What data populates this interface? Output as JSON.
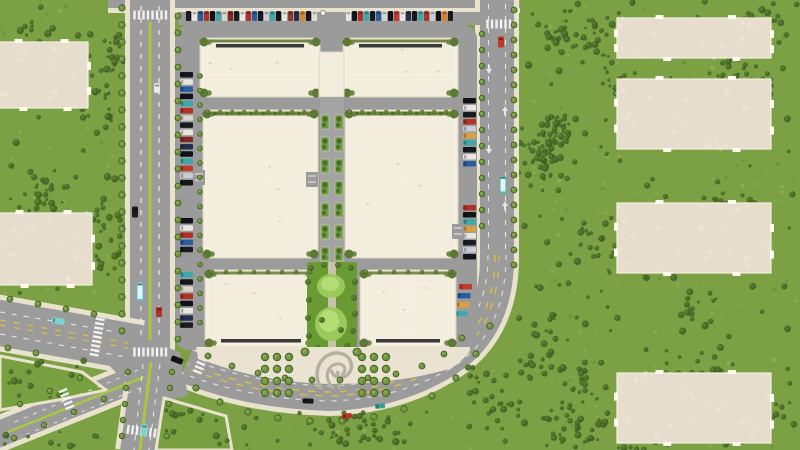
{
  "scene": {
    "width": 800,
    "height": 450,
    "description": "Top-down aerial city-builder view of a shopping mall complex with parking rows, tree-lined avenues, a landscaped plaza with emblem, central pocket park, and sand building pads on surrounding grassland"
  },
  "palette": {
    "grass_base": "#7ca044",
    "grass_light": "#93b455",
    "grass_dark": "#5f7f30",
    "grass_speck": "#a3c162",
    "tree_dark": "#3f6024",
    "tree_mid": "#577f2d",
    "street_tree": "#6e9140",
    "street_tree_rim": "#3f5c20",
    "road_asphalt": "#9b9b9b",
    "sidewalk": "#e9e2cd",
    "building_roof": "#f3eddd",
    "building_edge": "#ddd5c0",
    "roof_seam": "#ffffff",
    "roof_strip": "#3a3a3a",
    "hedge": "#6d813c",
    "hedge_tree": "#4c6d2a",
    "pad_sand": "#e6ddcd",
    "pad_tab": "#fffbee",
    "median_green": "#a7c93f",
    "lane_white": "#f2f2f2",
    "lane_yellow": "#d9c33c",
    "park_green": "#6a9a33",
    "lawn_light": "#9cc95c",
    "lawn_lighter": "#b5dd75",
    "plaza": "#eae3d1",
    "emblem_gray": "#b5afa3",
    "island_grass": "#78a040"
  },
  "mall": {
    "site": {
      "x": 175,
      "y": 25,
      "w": 302,
      "h": 325
    },
    "buildings": [
      {
        "id": "store-north-west",
        "x": 200,
        "y": 38,
        "w": 120,
        "h": 59,
        "style": "north"
      },
      {
        "id": "store-north-east",
        "x": 343,
        "y": 38,
        "w": 115,
        "h": 59,
        "style": "north"
      },
      {
        "id": "store-mid-west",
        "x": 203,
        "y": 110,
        "w": 115,
        "h": 148,
        "style": "mid"
      },
      {
        "id": "store-mid-east",
        "x": 345,
        "y": 110,
        "w": 113,
        "h": 148,
        "style": "mid"
      },
      {
        "id": "store-south-west",
        "x": 205,
        "y": 270,
        "w": 112,
        "h": 77,
        "style": "south"
      },
      {
        "id": "store-south-east",
        "x": 360,
        "y": 270,
        "w": 96,
        "h": 77,
        "style": "south-grid"
      }
    ],
    "connector": {
      "x": 319,
      "y": 52,
      "w": 25,
      "h": 45
    },
    "corridor": {
      "x": 320,
      "y": 97,
      "w": 24,
      "h": 173
    },
    "park": {
      "x": 307,
      "y": 262,
      "w": 50,
      "h": 91
    },
    "plaza": {
      "x": 196,
      "y": 347,
      "w": 274,
      "h": 50
    }
  },
  "pads": [
    {
      "id": "pad-left-1",
      "x": -10,
      "y": 42,
      "w": 98,
      "h": 66
    },
    {
      "id": "pad-left-2",
      "x": -10,
      "y": 213,
      "w": 102,
      "h": 72
    },
    {
      "id": "pad-right-1",
      "x": 617,
      "y": 18,
      "w": 154,
      "h": 40
    },
    {
      "id": "pad-right-2",
      "x": 617,
      "y": 79,
      "w": 154,
      "h": 70
    },
    {
      "id": "pad-right-3",
      "x": 617,
      "y": 203,
      "w": 154,
      "h": 70
    },
    {
      "id": "pad-right-4",
      "x": 617,
      "y": 373,
      "w": 154,
      "h": 70
    }
  ],
  "parking": {
    "top_row_west": [
      "#1a1c22",
      "#e8e6df",
      "#30599c",
      "#b03226",
      "#111318",
      "#3fa8a8",
      "#d8d5cc",
      "#7e2c22",
      "#1a1c22",
      "#e8e6df",
      "#b03226",
      "#2b5d9e",
      "#17191f",
      "#caced4",
      "#3fa8a8",
      "#101218",
      "#e8e6df",
      "#8f3a2c",
      "#23304d",
      "#d8822f",
      "#15171c",
      "#e0ddd4"
    ],
    "top_row_east": [
      "#e8e6df",
      "#15171c",
      "#b03226",
      "#3fa8a8",
      "#1a1c22",
      "#2b5d9e",
      "#d8d5cc",
      "#111318",
      "#c23a2c",
      "#e8e6df",
      "#23304d",
      "#17191f",
      "#3fa8a8",
      "#b03226",
      "#caced4",
      "#101218",
      "#d8822f",
      "#1a1c22"
    ],
    "left_col_a": [
      "#15171c",
      "#e8e6df",
      "#2b5d9e",
      "#111318",
      "#3fa8a8",
      "#b03226",
      "#d8d5cc",
      "#1a1c22",
      "#e8e6df",
      "#7e2c22",
      "#23304d",
      "#101218",
      "#3fa8a8",
      "#c23a2c",
      "#caced4",
      "#15171c"
    ],
    "left_col_b": [
      "#111318",
      "#e8e6df",
      "#b03226",
      "#2b5d9e",
      "#1a1c22"
    ],
    "left_col_c": [
      "#3fa8a8",
      "#15171c",
      "#d8d5cc",
      "#b03226",
      "#111318",
      "#e8e6df",
      "#23304d",
      "#1a1c22"
    ],
    "right_col_a": [
      "#111318",
      "#e8e6df",
      "#1a1c22",
      "#b03226",
      "#caced4",
      "#d8a13d",
      "#3fa8a8",
      "#15171c",
      "#e8e6df",
      "#2b5d9e"
    ],
    "right_col_b": [
      "#b03226",
      "#111318",
      "#3fa8a8",
      "#d8a13d",
      "#e8e6df",
      "#1a1c22",
      "#caced4",
      "#15171c"
    ],
    "right_col_curve": [
      "#c23a2c",
      "#2b5d9e",
      "#d8a13d",
      "#3fa8a8"
    ]
  },
  "vehicles": [
    {
      "name": "car-red-right-avenue",
      "x": 501,
      "y": 42,
      "w": 6,
      "h": 11,
      "angle": 0,
      "color": "#c0392b",
      "kind": "car"
    },
    {
      "name": "bus-teal-right-avenue",
      "x": 503,
      "y": 185,
      "w": 7,
      "h": 17,
      "angle": 0,
      "color": "#4ab5ad",
      "kind": "bus"
    },
    {
      "name": "car-white-west-avenue",
      "x": 157,
      "y": 88,
      "w": 6,
      "h": 10,
      "angle": 0,
      "color": "#e8e8e4",
      "kind": "car"
    },
    {
      "name": "car-black-west-avenue",
      "x": 135,
      "y": 212,
      "w": 6,
      "h": 11,
      "angle": 0,
      "color": "#1c1c1e",
      "kind": "car"
    },
    {
      "name": "bus-cyan-west-avenue",
      "x": 140,
      "y": 292,
      "w": 7,
      "h": 18,
      "angle": 0,
      "color": "#58c2c9",
      "kind": "bus"
    },
    {
      "name": "car-red-west-avenue",
      "x": 159,
      "y": 312,
      "w": 6,
      "h": 10,
      "angle": 0,
      "color": "#b23327",
      "kind": "car"
    },
    {
      "name": "car-cyan-west-road",
      "x": 58,
      "y": 321,
      "w": 13,
      "h": 6,
      "angle": 10,
      "color": "#7fd4d0",
      "kind": "car"
    },
    {
      "name": "car-black-boulevard-west",
      "x": 177,
      "y": 360,
      "w": 12,
      "h": 6,
      "angle": 20,
      "color": "#151515",
      "kind": "car"
    },
    {
      "name": "car-black-boulevard",
      "x": 308,
      "y": 401,
      "w": 11,
      "h": 5,
      "angle": 2,
      "color": "#181818",
      "kind": "car"
    },
    {
      "name": "car-teal-boulevard",
      "x": 380,
      "y": 406,
      "w": 10,
      "h": 5,
      "angle": -6,
      "color": "#3f9e8f",
      "kind": "car"
    },
    {
      "name": "car-red-boulevard",
      "x": 347,
      "y": 416,
      "w": 10,
      "h": 5,
      "angle": -8,
      "color": "#b23327",
      "kind": "car"
    },
    {
      "name": "car-cyan-south-road",
      "x": 144,
      "y": 430,
      "w": 6,
      "h": 12,
      "angle": 6,
      "color": "#7fd4d0",
      "kind": "car"
    }
  ],
  "props": {
    "round-prop": {
      "x": 323,
      "y": 13,
      "r": 2.5,
      "color": "#f4f2ea"
    }
  }
}
